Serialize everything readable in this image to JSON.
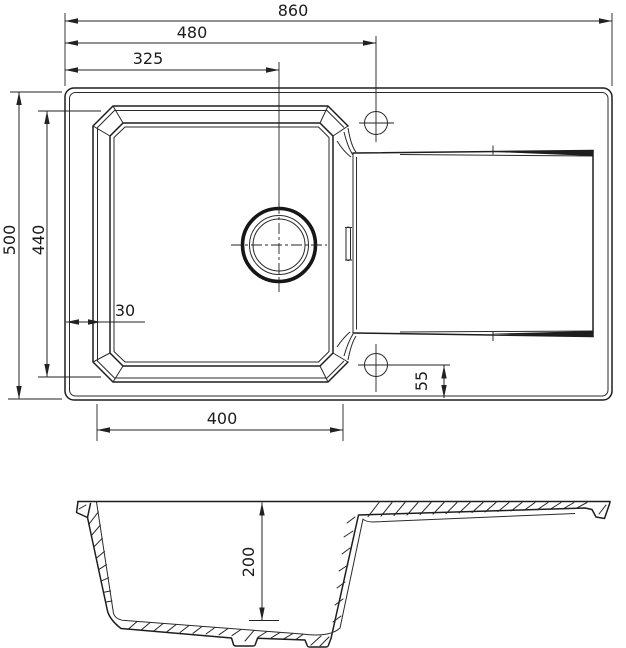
{
  "dims": {
    "overall_width": "860",
    "hole_centerline_from_left": "480",
    "drain_centerline_from_left": "325",
    "overall_depth": "500",
    "bowl_outer_depth": "440",
    "bowl_offset_left": "30",
    "bowl_width": "400",
    "hole_offset_from_edge": "55",
    "bowl_depth": "200"
  }
}
